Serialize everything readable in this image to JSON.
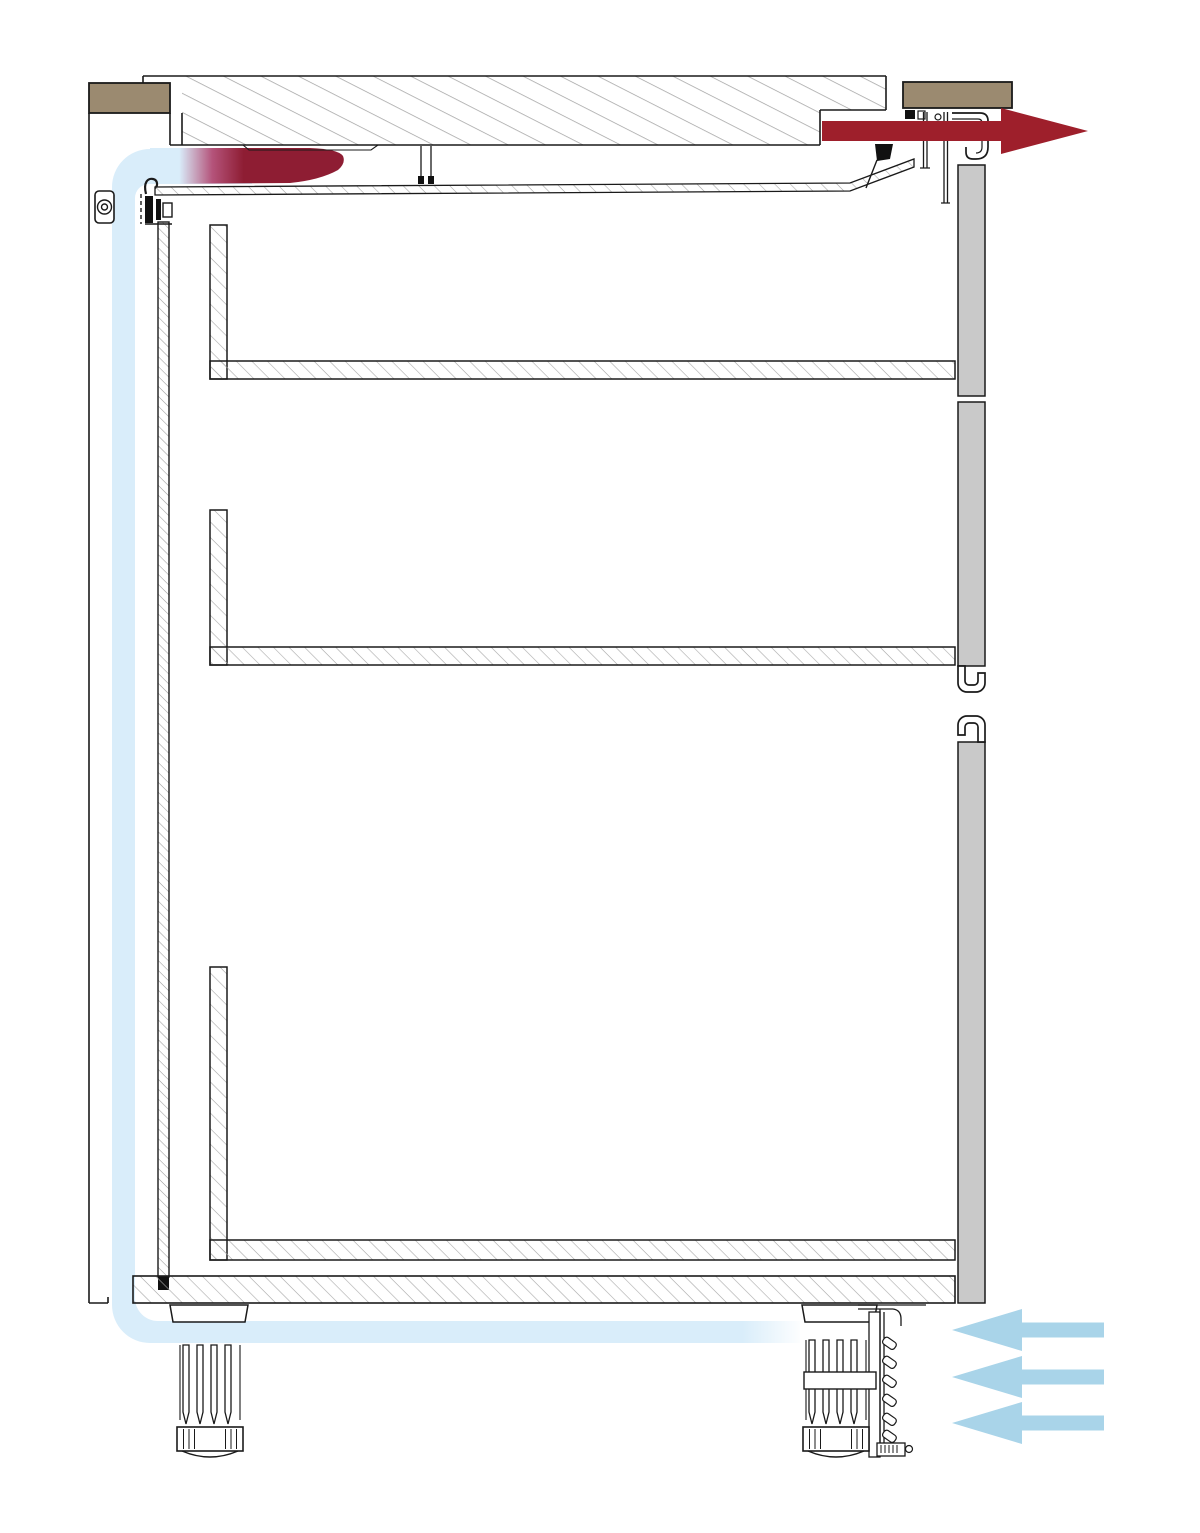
{
  "diagram": {
    "subject": "base-cabinet-section-with-appliance-ventilation",
    "airflow": {
      "cool_air_inlet_arrows": 3,
      "inlet_side": "bottom-right",
      "inlet_direction": "left",
      "warm_air_outlet_arrows": 1,
      "outlet_side": "top-right",
      "outlet_direction": "right"
    },
    "counts": {
      "drawers": 3,
      "adjustable_feet": 2,
      "worktop_end_caps": 2,
      "side_panel_segments": 3,
      "grille_louvers": 6
    },
    "colors": {
      "cool_air_arrow": "#a9d4e9",
      "cool_air_band": "#d9edfa",
      "warm_air": "#9e1f2b",
      "warm_air_deep": "#8e1d33",
      "transition_pink": "#b4537a",
      "worktop_cap": "#9b8a70",
      "panel_gray": "#c9c9c9",
      "line": "#1a1a1a",
      "hatch": "#a3a3a3"
    }
  }
}
